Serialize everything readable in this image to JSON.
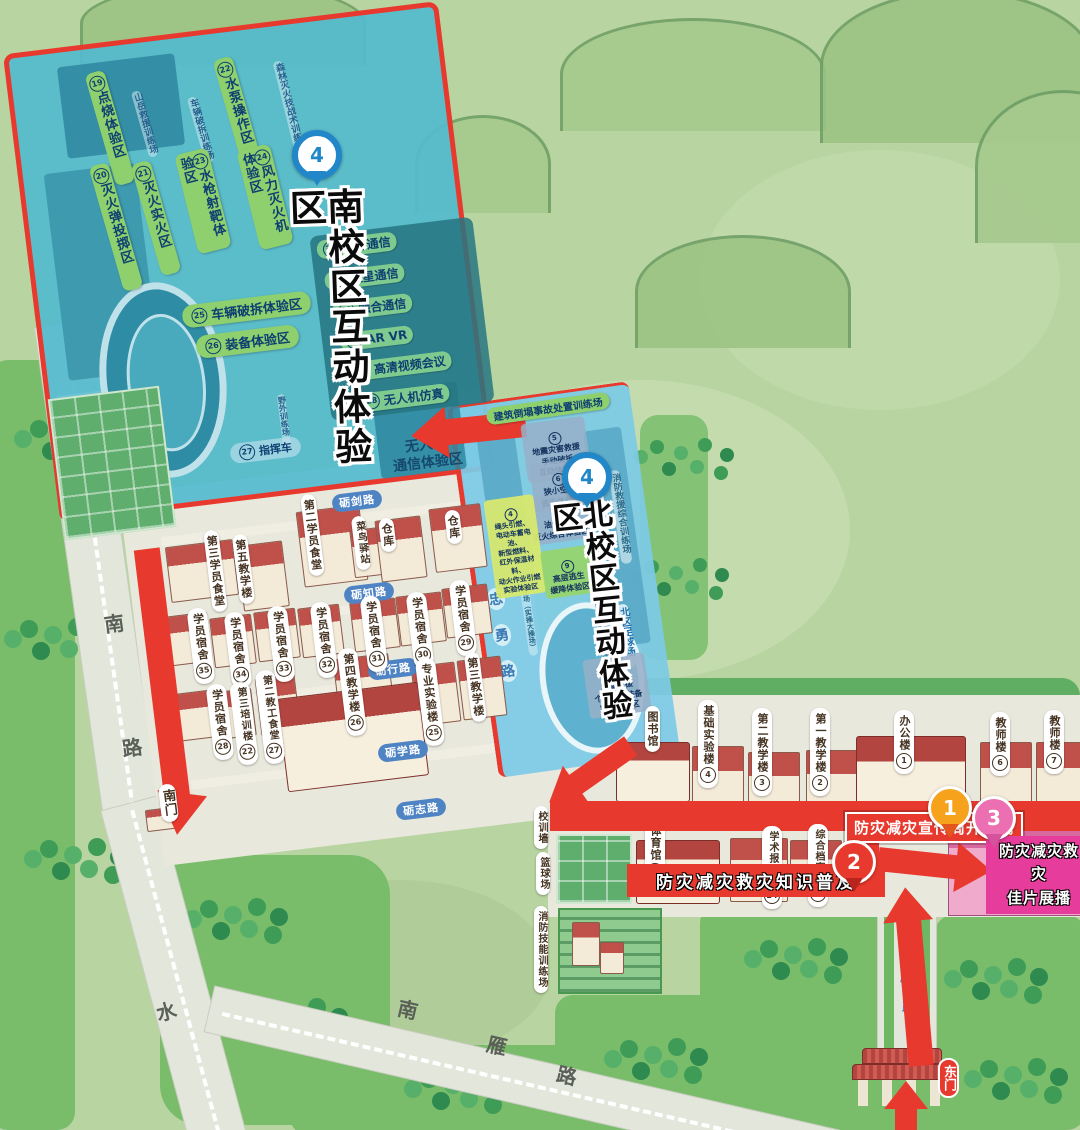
{
  "colors": {
    "route_red": "#e8392e",
    "zone_green": "#8ed06e",
    "south_zone_blue": "#54bacd",
    "north_zone_blue": "#7dcae6",
    "road_pill_blue": "#4f84c4",
    "banner_pink": "#e63c9b",
    "pin_blue": "#2187c8",
    "pin_orange": "#f6a21d",
    "pin_pink": "#ec6fb1",
    "map_green": "#b8d4a1"
  },
  "south_zone": {
    "marker": "4",
    "title": "南校区互动体验区",
    "zones": [
      {
        "num": "19",
        "text": "点烧体验区"
      },
      {
        "num": "20",
        "text": "灭火弹投掷区"
      },
      {
        "num": "21",
        "text": "灭火实火区"
      },
      {
        "num": "22",
        "text": "水泵操作区"
      },
      {
        "num": "23",
        "text": "水枪射靶体验区"
      },
      {
        "num": "24",
        "text": "风力灭火机体验区"
      },
      {
        "num": "25",
        "text": "车辆破拆体验区"
      },
      {
        "num": "26",
        "text": "装备体验区"
      },
      {
        "num": "27",
        "text": "指挥车"
      },
      {
        "num": "28",
        "text": "无人机仿真"
      },
      {
        "num": "29",
        "text": "高清视频会议"
      },
      {
        "num": "30",
        "text": "AR VR"
      },
      {
        "num": "31",
        "text": "融合通信"
      },
      {
        "num": "32",
        "text": "卫星通信"
      },
      {
        "num": "33",
        "text": "光纤通信"
      }
    ],
    "fields": [
      "山岳救援训练场",
      "车辆破拆训练场",
      "森林灭火技战术训练场",
      "野外训练场"
    ],
    "drone_comm": "无人机\n通信体验区"
  },
  "north_zone": {
    "marker": "4",
    "title": "北校区互动体验区",
    "header": "建筑倒塌事故处置训练场",
    "zones": [
      {
        "num": "5",
        "text": "地震灾害救援\n手动破拆\n互动体验区"
      },
      {
        "num": "6",
        "text": "狭小空间\n逃生体验区"
      },
      {
        "num": "8",
        "text": "油区防火\n灭火综合体验区"
      },
      {
        "num": "4",
        "text": "绳头引燃、\n电动车蓄电池、\n新型燃料、\n红外保温材料、\n动火作业引燃\n实验体验区"
      },
      {
        "num": "9",
        "text": "高层逃生\n缓降体验区"
      },
      {
        "num": "1",
        "text": "高空缓降体验区"
      },
      {
        "num": "10",
        "text": "水域救援\n个人防护装备\n实操体验区"
      }
    ],
    "fields": [
      "消防救援综合训练场",
      "北区足球场",
      "田径场（实操大操场）"
    ]
  },
  "buildings": [
    {
      "text": "第三学员食堂"
    },
    {
      "text": "第五教学楼"
    },
    {
      "text": "第二学员食堂"
    },
    {
      "text": "菜鸟驿站"
    },
    {
      "text": "仓库"
    },
    {
      "text": "仓库"
    },
    {
      "text": "学员宿舍",
      "num": "35"
    },
    {
      "text": "学员宿舍",
      "num": "34"
    },
    {
      "text": "学员宿舍",
      "num": "33"
    },
    {
      "text": "学员宿舍",
      "num": "32"
    },
    {
      "text": "学员宿舍",
      "num": "31"
    },
    {
      "text": "学员宿舍",
      "num": "30"
    },
    {
      "text": "学员宿舍",
      "num": "29"
    },
    {
      "text": "学员宿舍",
      "num": "28"
    },
    {
      "text": "第三培训楼",
      "num": "22"
    },
    {
      "text": "第二教工食堂",
      "num": "27"
    },
    {
      "text": "第四教学楼",
      "num": "26"
    },
    {
      "text": "专业实验楼",
      "num": "25"
    },
    {
      "text": "第三教学楼"
    },
    {
      "text": "体育馆",
      "num": "23"
    },
    {
      "text": "学术报告厅",
      "num": "24"
    },
    {
      "text": "综合档案室",
      "num": "20"
    },
    {
      "text": "图书馆"
    },
    {
      "text": "基础实验楼",
      "num": "4"
    },
    {
      "text": "第二教学楼",
      "num": "3"
    },
    {
      "text": "第一教学楼",
      "num": "2"
    },
    {
      "text": "办公楼",
      "num": "1"
    },
    {
      "text": "教师楼",
      "num": "6"
    },
    {
      "text": "教师楼",
      "num": "7"
    },
    {
      "text": "俱乐部"
    },
    {
      "text": "校训墙"
    },
    {
      "text": "篮球场"
    },
    {
      "text": "消防技能训练场"
    }
  ],
  "roads": {
    "shuinan": {
      "name": "水南路",
      "chars": [
        "水",
        "南",
        "路"
      ],
      "extra": "水"
    },
    "nanyan": {
      "name": "南雁路",
      "chars": [
        "南",
        "雁",
        "路"
      ]
    },
    "zhongyong": {
      "name": "忠勇路",
      "chars": [
        "忠",
        "勇",
        "路"
      ]
    },
    "liying": {
      "name": "砺鹰路",
      "chars": [
        "砺",
        "鹰",
        "路"
      ]
    },
    "pills": [
      "砺剑路",
      "砺知路",
      "砺行路",
      "砺学路",
      "砺志路"
    ]
  },
  "banners": [
    {
      "text": "防灾减灾宣传周开幕式"
    },
    {
      "text": "防灾减灾救灾知识普及"
    },
    {
      "text": "防灾减灾救灾\n佳片展播"
    }
  ],
  "markers": {
    "one": "1",
    "two": "2",
    "three": "3"
  },
  "gates": {
    "east": "东门",
    "south": "南门"
  }
}
